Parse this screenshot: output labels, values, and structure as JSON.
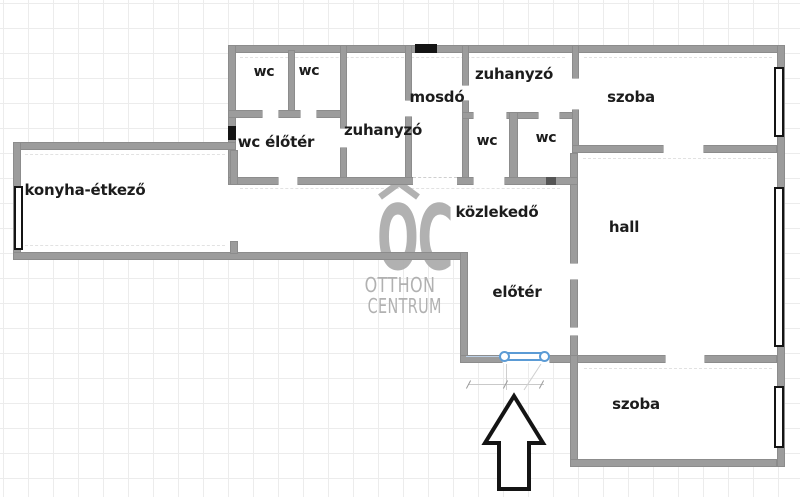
{
  "colors": {
    "wall": "#9c9c9c",
    "grid": "#ececec",
    "background": "#ffffff",
    "label": "#1c1c1c",
    "watermark": "#ababab",
    "door": "#5b9bd5",
    "window_frame": "#141414",
    "arrow_outline": "#141414"
  },
  "watermark": {
    "logo": "OC",
    "line1": "OTTHON",
    "line2": "CENTRUM"
  },
  "rooms": {
    "wc_top_1": {
      "label": "wc"
    },
    "wc_top_2": {
      "label": "wc"
    },
    "wc_eloter": {
      "label": "wc élőtér"
    },
    "zuhanyzo_left": {
      "label": "zuhanyzó"
    },
    "mosdo": {
      "label": "mosdó"
    },
    "zuhanyzo_right": {
      "label": "zuhanyzó"
    },
    "wc_right_1": {
      "label": "wc"
    },
    "wc_right_2": {
      "label": "wc"
    },
    "szoba_top": {
      "label": "szoba"
    },
    "konyha_etkezo": {
      "label": "konyha-étkező"
    },
    "kozlekedo": {
      "label": "közlekedő"
    },
    "hall": {
      "label": "hall"
    },
    "eloter": {
      "label": "előtér"
    },
    "szoba_bottom": {
      "label": "szoba"
    }
  },
  "icons": {
    "entrance_arrow": "up-arrow",
    "entrance_door": "double-door-blue",
    "windows": "black-window-bars",
    "vents": "black-wall-vents"
  }
}
